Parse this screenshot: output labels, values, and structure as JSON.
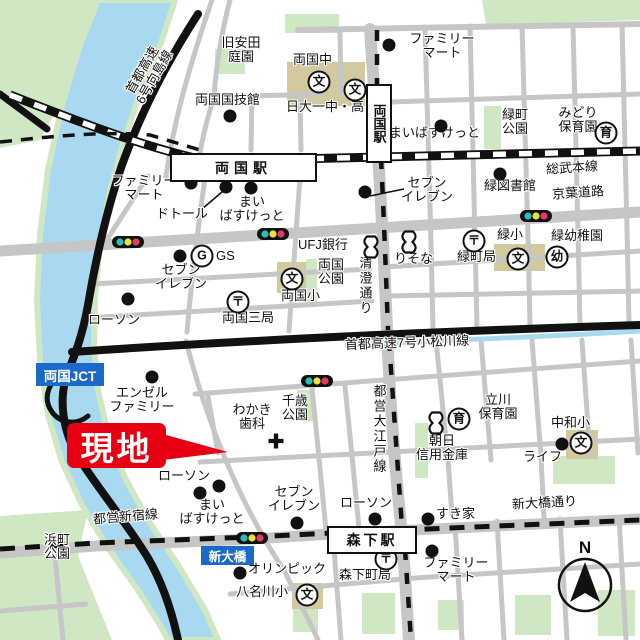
{
  "map": {
    "site_label": "現地",
    "compass_n": "N",
    "junction_label": "両国JCT",
    "bridge_label": "新大橋",
    "stations": {
      "jr_ryogoku": "両国駅",
      "oedo_ryogoku": "両国駅",
      "morishita": "森下駅"
    },
    "colors": {
      "river": "#a9d9f1",
      "park_green": "#cfe7c2",
      "school_ground": "#d3c99e",
      "road_gray": "#c6c6c6",
      "marker_red": "#e60012",
      "label_blue": "#1b6ac9",
      "signal_teal": "#2fb9b9",
      "signal_yellow": "#e8e23e",
      "signal_red": "#e23a64"
    },
    "icon_glyphs": {
      "post": "〒",
      "school": "文",
      "kinder": "幼",
      "nursery": "育",
      "gas": "G"
    },
    "labels": [
      {
        "t": [
          "旧安田",
          "庭園"
        ],
        "x": 241,
        "y": 36,
        "a": "c"
      },
      {
        "t": [
          "両国中"
        ],
        "x": 293,
        "y": 53
      },
      {
        "t": [
          "日大一中・高"
        ],
        "x": 286,
        "y": 100
      },
      {
        "t": [
          "両国国技館"
        ],
        "x": 195,
        "y": 93
      },
      {
        "t": [
          "ファミリー",
          "マート"
        ],
        "x": 442,
        "y": 32,
        "a": "c"
      },
      {
        "t": [
          "まいばすけっと"
        ],
        "x": 389,
        "y": 126
      },
      {
        "t": [
          "緑町",
          "公園"
        ],
        "x": 502,
        "y": 108
      },
      {
        "t": [
          "みどり",
          "保育園"
        ],
        "x": 578,
        "y": 106,
        "a": "c"
      },
      {
        "t": [
          "総武本線"
        ],
        "x": 546,
        "y": 161,
        "r": -4
      },
      {
        "t": [
          "京葉道路"
        ],
        "x": 552,
        "y": 186,
        "r": -4
      },
      {
        "t": [
          "セブン",
          "イレブン"
        ],
        "x": 427,
        "y": 176,
        "a": "c"
      },
      {
        "t": [
          "緑図書館"
        ],
        "x": 484,
        "y": 179
      },
      {
        "t": [
          "緑小"
        ],
        "x": 497,
        "y": 228
      },
      {
        "t": [
          "緑幼稚園"
        ],
        "x": 551,
        "y": 229
      },
      {
        "t": [
          "緑町局"
        ],
        "x": 457,
        "y": 250
      },
      {
        "t": [
          "りそな"
        ],
        "x": 394,
        "y": 252
      },
      {
        "t": [
          "UFJ銀行"
        ],
        "x": 298,
        "y": 238
      },
      {
        "t": [
          "両国",
          "公園"
        ],
        "x": 318,
        "y": 258
      },
      {
        "t": [
          "両国小"
        ],
        "x": 281,
        "y": 289
      },
      {
        "t": [
          "清澄通り"
        ],
        "x": 358,
        "y": 256,
        "v": 1
      },
      {
        "t": [
          "ファミリー",
          "マート"
        ],
        "x": 144,
        "y": 174,
        "a": "c"
      },
      {
        "t": [
          "ドトール"
        ],
        "x": 156,
        "y": 207
      },
      {
        "t": [
          "まい",
          "ばすけっと"
        ],
        "x": 252,
        "y": 195,
        "a": "c"
      },
      {
        "t": [
          "セブン",
          "イレブン"
        ],
        "x": 181,
        "y": 263,
        "a": "c"
      },
      {
        "t": [
          "GS"
        ],
        "x": 216,
        "y": 249
      },
      {
        "t": [
          "ローソン"
        ],
        "x": 88,
        "y": 313
      },
      {
        "t": [
          "両国三局"
        ],
        "x": 222,
        "y": 311
      },
      {
        "t": [
          "首都高速7号小松川線"
        ],
        "x": 345,
        "y": 336,
        "r": -2
      },
      {
        "t": [
          "エンゼル",
          "ファミリー"
        ],
        "x": 142,
        "y": 386,
        "a": "c"
      },
      {
        "t": [
          "わかき",
          "歯科"
        ],
        "x": 252,
        "y": 403,
        "a": "c"
      },
      {
        "t": [
          "千歳",
          "公園"
        ],
        "x": 282,
        "y": 394
      },
      {
        "t": [
          "都営大江戸線"
        ],
        "x": 372,
        "y": 384,
        "v": 1
      },
      {
        "t": [
          "立川",
          "保育園"
        ],
        "x": 498,
        "y": 393,
        "a": "c"
      },
      {
        "t": [
          "朝日",
          "信用金庫"
        ],
        "x": 442,
        "y": 434,
        "a": "c"
      },
      {
        "t": [
          "中和小"
        ],
        "x": 551,
        "y": 416
      },
      {
        "t": [
          "ライフ"
        ],
        "x": 523,
        "y": 450
      },
      {
        "t": [
          "ローソン"
        ],
        "x": 158,
        "y": 469
      },
      {
        "t": [
          "まい",
          "ばすけっと"
        ],
        "x": 212,
        "y": 498,
        "a": "c"
      },
      {
        "t": [
          "セブン",
          "イレブン"
        ],
        "x": 294,
        "y": 485,
        "a": "c"
      },
      {
        "t": [
          "ローソン"
        ],
        "x": 340,
        "y": 496
      },
      {
        "t": [
          "すき家"
        ],
        "x": 436,
        "y": 507
      },
      {
        "t": [
          "新大橋通り"
        ],
        "x": 512,
        "y": 496,
        "r": -3
      },
      {
        "t": [
          "都営新宿線"
        ],
        "x": 93,
        "y": 510,
        "r": -5
      },
      {
        "t": [
          "浜町",
          "公園"
        ],
        "x": 44,
        "y": 533
      },
      {
        "t": [
          "オリンピック"
        ],
        "x": 248,
        "y": 562
      },
      {
        "t": [
          "森下町局"
        ],
        "x": 339,
        "y": 568
      },
      {
        "t": [
          "八名川小"
        ],
        "x": 236,
        "y": 585
      },
      {
        "t": [
          "ファミリー",
          "マート"
        ],
        "x": 456,
        "y": 556,
        "a": "c"
      },
      {
        "t": [
          "首都高速",
          "6号向島線"
        ],
        "x": 148,
        "y": 60,
        "a": "c",
        "r": -60
      }
    ],
    "icons": [
      {
        "t": "post",
        "x": 474,
        "y": 241
      },
      {
        "t": "post",
        "x": 238,
        "y": 302
      },
      {
        "t": "post",
        "x": 386,
        "y": 559
      },
      {
        "t": "school",
        "x": 319,
        "y": 82
      },
      {
        "t": "school",
        "x": 355,
        "y": 90
      },
      {
        "t": "school",
        "x": 292,
        "y": 279
      },
      {
        "t": "school",
        "x": 518,
        "y": 259
      },
      {
        "t": "school",
        "x": 581,
        "y": 443
      },
      {
        "t": "school",
        "x": 307,
        "y": 595
      },
      {
        "t": "kinder",
        "x": 557,
        "y": 257
      },
      {
        "t": "nursery",
        "x": 606,
        "y": 133
      },
      {
        "t": "nursery",
        "x": 459,
        "y": 419
      },
      {
        "t": "gas",
        "x": 202,
        "y": 256
      },
      {
        "t": "bank",
        "x": 371,
        "y": 247
      },
      {
        "t": "bank",
        "x": 409,
        "y": 242
      },
      {
        "t": "bank",
        "x": 436,
        "y": 423
      },
      {
        "t": "hospital",
        "x": 276,
        "y": 441
      },
      {
        "t": "dot",
        "x": 389,
        "y": 45
      },
      {
        "t": "dot",
        "x": 441,
        "y": 126
      },
      {
        "t": "dot",
        "x": 230,
        "y": 116
      },
      {
        "t": "dot",
        "x": 191,
        "y": 183
      },
      {
        "t": "dot",
        "x": 226,
        "y": 187
      },
      {
        "t": "dot",
        "x": 251,
        "y": 188
      },
      {
        "t": "dot",
        "x": 180,
        "y": 256
      },
      {
        "t": "dot",
        "x": 128,
        "y": 299
      },
      {
        "t": "dot",
        "x": 500,
        "y": 174
      },
      {
        "t": "dot",
        "x": 365,
        "y": 192
      },
      {
        "t": "dot",
        "x": 152,
        "y": 377
      },
      {
        "t": "dot",
        "x": 562,
        "y": 444
      },
      {
        "t": "dot",
        "x": 428,
        "y": 519
      },
      {
        "t": "dot",
        "x": 200,
        "y": 493
      },
      {
        "t": "dot",
        "x": 219,
        "y": 486
      },
      {
        "t": "dot",
        "x": 297,
        "y": 523
      },
      {
        "t": "dot",
        "x": 375,
        "y": 519
      },
      {
        "t": "dot",
        "x": 240,
        "y": 573
      },
      {
        "t": "dot",
        "x": 432,
        "y": 551
      },
      {
        "t": "traffic",
        "x": 128,
        "y": 242
      },
      {
        "t": "traffic",
        "x": 273,
        "y": 234
      },
      {
        "t": "traffic",
        "x": 536,
        "y": 216
      },
      {
        "t": "traffic",
        "x": 317,
        "y": 381
      },
      {
        "t": "traffic",
        "x": 252,
        "y": 538
      }
    ]
  }
}
